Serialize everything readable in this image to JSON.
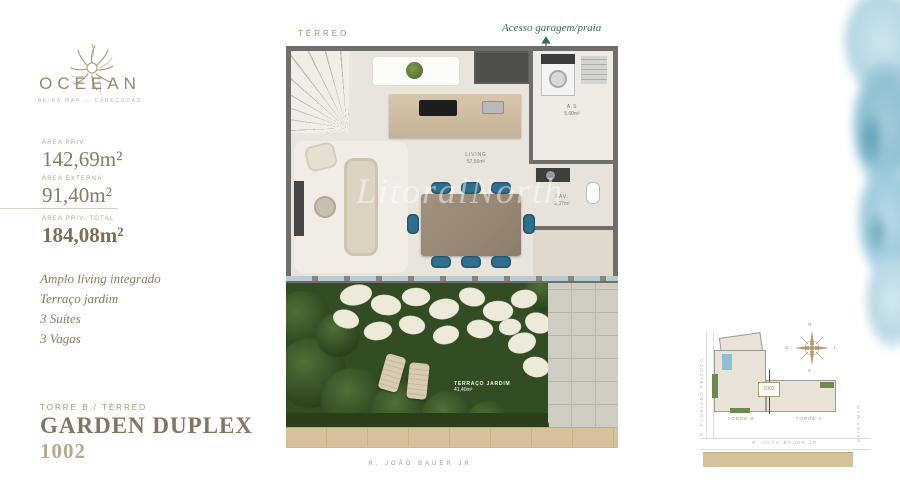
{
  "brand": {
    "name": "OCEEAN",
    "tagline": "BEIRA MAR — CABEÇUDAS"
  },
  "colors": {
    "gold": "#a5916b",
    "teal": "#3c6a64",
    "garden_green": "#324d24",
    "water_blue": "#9cc8d8"
  },
  "areas": {
    "priv": {
      "label": "ÁREA PRIV.",
      "value": "142,69m²"
    },
    "externa": {
      "label": "ÁREA EXTERNA",
      "value": "91,40m²"
    },
    "total": {
      "label": "ÁREA PRIV. TOTAL",
      "value": "184,08m²"
    }
  },
  "features": {
    "f1": "Amplo living integrado",
    "f2": "Terraço jardim",
    "f3": "3 Suítes",
    "f4": "3 Vagas"
  },
  "unit": {
    "tower": "TORRE B / TÉRREO",
    "name": "GARDEN DUPLEX",
    "number": "1002"
  },
  "plan": {
    "floor_label": "TÉRREO",
    "access_label": "Acesso garagem/praia",
    "living": {
      "name": "LIVING",
      "area": "57,56m²"
    },
    "service": {
      "name": "A.S",
      "area": "5,60m²"
    },
    "lav": {
      "name": "LAV.",
      "area": "2,37m²"
    },
    "terrace": {
      "name": "TERRAÇO JARDIM",
      "area": "41,40m²"
    },
    "street": "R. JOÃO BAUER JR",
    "watermark": "LitoralNorth"
  },
  "minimap": {
    "tower_b": "TORRE B",
    "tower_a": "TORRE A",
    "unit": "1002",
    "street_left": "R. FLORIANO PEIXOTO",
    "street_right": "BEIRA MAR",
    "street_bottom": "R. JOÃO BAUER JR",
    "compass": {
      "n": "N",
      "s": "S",
      "e": "L",
      "w": "O"
    }
  }
}
